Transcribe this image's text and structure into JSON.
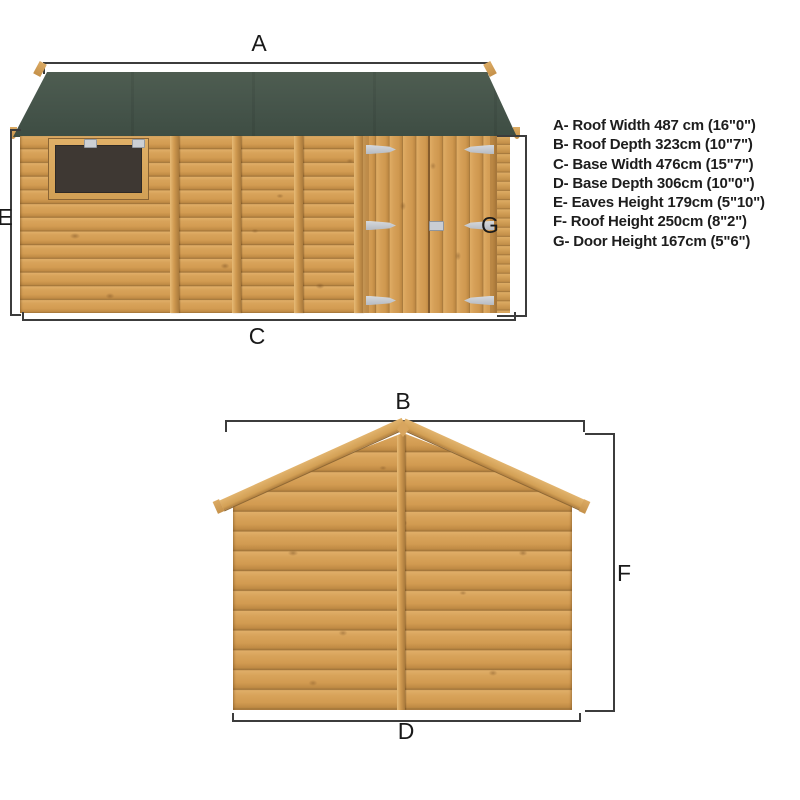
{
  "legend": {
    "items": [
      "A- Roof Width 487 cm (16\"0\")",
      "B- Roof Depth 323cm (10\"7\")",
      "C- Base Width 476cm (15\"7\")",
      "D- Base Depth 306cm (10\"0\")",
      "E- Eaves Height 179cm (5\"10\")",
      "F- Roof Height 250cm (8\"2\")",
      "G- Door Height 167cm (5\"6\")"
    ]
  },
  "front_view": {
    "dim_labels": {
      "roof_width": "A",
      "eaves_height": "E",
      "door_height": "G",
      "base_width": "C"
    }
  },
  "side_view": {
    "dim_labels": {
      "roof_depth": "B",
      "roof_height": "F",
      "base_depth": "D"
    }
  },
  "colors": {
    "roof_green": "#46554a",
    "wood": "#d5a05a",
    "window_glass": "#3e3833",
    "dimension_line": "#3c3c3c",
    "text": "#1d1d1d"
  }
}
